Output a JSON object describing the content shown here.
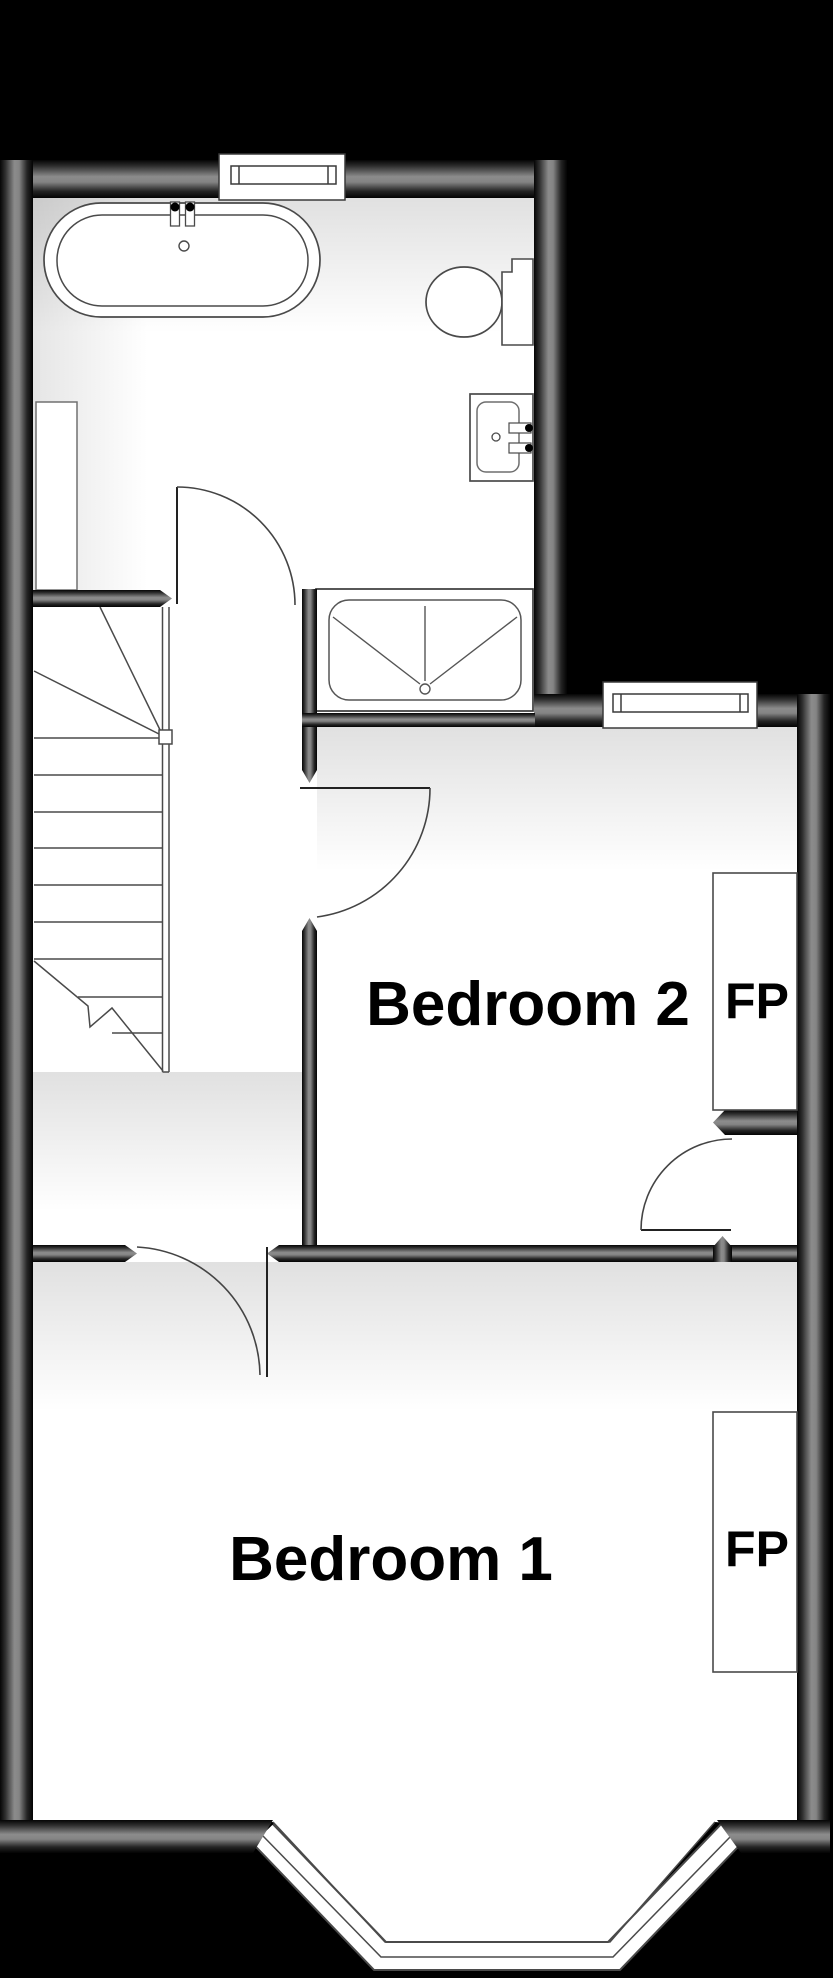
{
  "labels": {
    "bedroom1": "Bedroom 1",
    "bedroom2": "Bedroom 2",
    "fireplace1": "FP",
    "fireplace2": "FP"
  },
  "colors": {
    "background": "#000000",
    "floor": "#ffffff",
    "wall_edge": "#0a0a0a",
    "wall_mid": "#8c8c8c",
    "line": "#4a4a4a",
    "text": "#000000"
  }
}
